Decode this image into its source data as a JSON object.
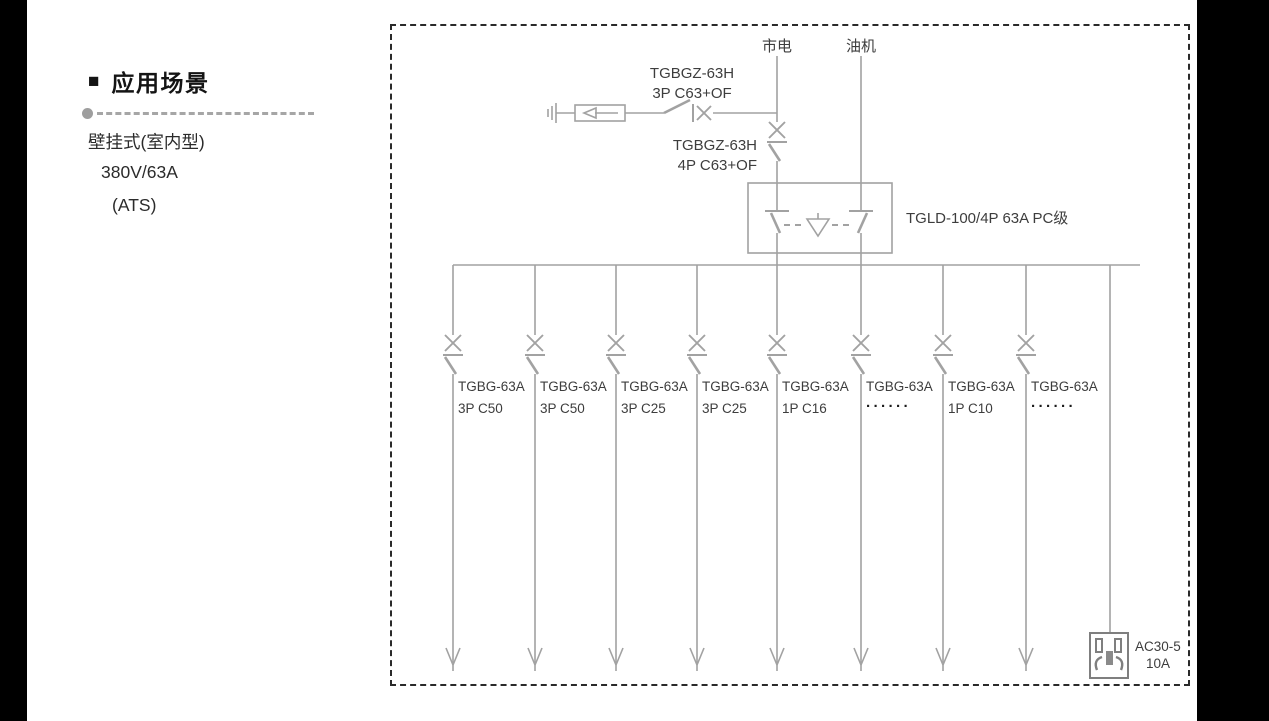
{
  "left_panel": {
    "bullet": "■",
    "heading": "应用场景",
    "subtitle_lines": [
      "壁挂式(室内型)",
      "380V/63A",
      "(ATS)"
    ]
  },
  "diagram": {
    "mains_label": "市电",
    "generator_label": "油机",
    "surge_breaker": {
      "line1": "TGBGZ-63H",
      "line2": "3P C63+OF"
    },
    "main_breaker": {
      "line1": "TGBGZ-63H",
      "line2": "4P C63+OF"
    },
    "ats_label": "TGLD-100/4P 63A PC级",
    "branches": [
      {
        "model": "TGBG-63A",
        "spec": "3P C50"
      },
      {
        "model": "TGBG-63A",
        "spec": "3P C50"
      },
      {
        "model": "TGBG-63A",
        "spec": "3P C25"
      },
      {
        "model": "TGBG-63A",
        "spec": "3P C25"
      },
      {
        "model": "TGBG-63A",
        "spec": "1P C16"
      },
      {
        "model": "TGBG-63A",
        "spec": "······"
      },
      {
        "model": "TGBG-63A",
        "spec": "1P C10"
      },
      {
        "model": "TGBG-63A",
        "spec": "······"
      }
    ],
    "socket_label": {
      "line1": "AC30-5",
      "line2": "10A"
    }
  },
  "colors": {
    "line_gray": "#a2a2a2",
    "label_text": "#3d3d3d",
    "frame_border": "#2a2a2a",
    "side_strip": "#000000"
  }
}
